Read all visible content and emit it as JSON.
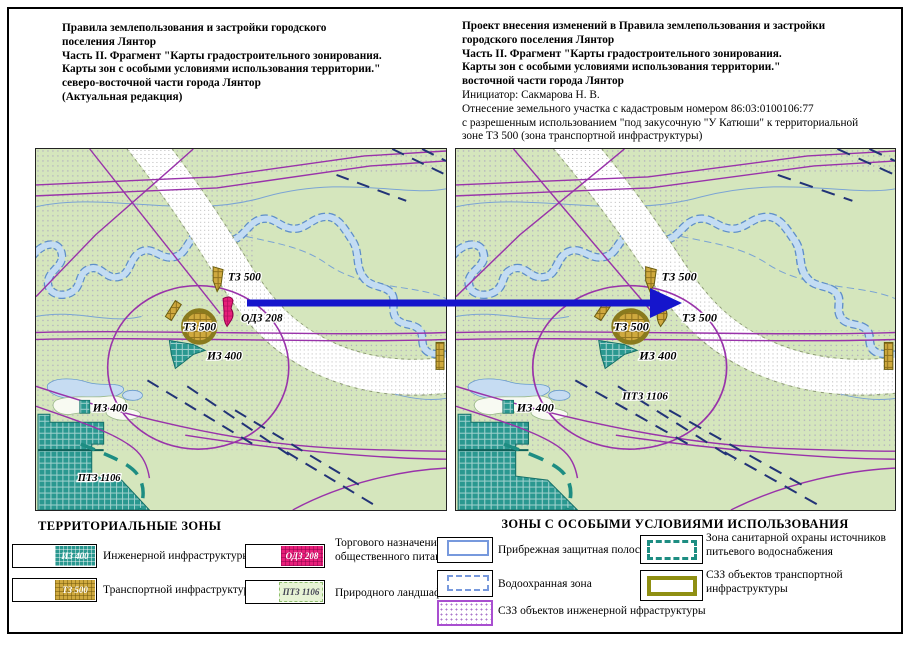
{
  "header_left": {
    "lines": [
      "Правила землепользования и застройки городского",
      "поселения Лянтор",
      "Часть II. Фрагмент \"Карты градостроительного зонирования.",
      "Карты зон с особыми условиями использования территории.\"",
      "северо-восточной части города Лянтор",
      "(Актуальная редакция)"
    ]
  },
  "header_right": {
    "bold_lines": [
      "Проект внесения изменений в Правила землепользования и застройки",
      "городского поселения Лянтор",
      "Часть II. Фрагмент \"Карты градостроительного зонирования.",
      "Карты зон с особыми условиями использования территории.\"",
      "восточной части города Лянтор"
    ],
    "normal_lines": [
      "Инициатор: Сакмарова Н. В.",
      "Отнесение земельного участка с кадастровым номером 86:03:0100106:77",
      "с разрешенным использованием \"под закусочную \"У Катюши\" к территориальной",
      "зоне ТЗ 500 (зона транспортной инфраструктуры)"
    ]
  },
  "maps": {
    "left": {
      "title": "Актуальная редакция",
      "patch_type": "odz",
      "labels": {
        "tz500_top": "ТЗ 500",
        "patch": "ОДЗ 208",
        "tz500_main": "ТЗ 500",
        "iz400_center": "ИЗ 400",
        "iz400_bottom": "ИЗ 400",
        "ptz1106": "ПТЗ 1106"
      }
    },
    "right": {
      "title": "Проект изменений",
      "patch_type": "tz",
      "labels": {
        "tz500_top": "ТЗ 500",
        "patch": "ТЗ 500",
        "tz500_main": "ТЗ 500",
        "iz400_center": "ИЗ 400",
        "iz400_bottom": "ИЗ 400",
        "ptz1106": "ПТЗ 1106"
      }
    }
  },
  "legend_territorial": {
    "title": "ТЕРРИТОРИАЛЬНЫЕ ЗОНЫ",
    "items": [
      {
        "code": "ИЗ 400",
        "color": "#2a9890",
        "label_lines": [
          "Инженерной инфраструктуры"
        ]
      },
      {
        "code": "ТЗ 500",
        "color": "#cfa93e",
        "label_lines": [
          "Транспортной инфраструктуры"
        ]
      },
      {
        "code": "ОДЗ 208",
        "color": "#e81f7a",
        "label_lines": [
          "Торгового назначения и",
          "общественного питания"
        ]
      },
      {
        "code": "ПТЗ 1106",
        "color": "#e7f3d5",
        "label_lines": [
          "Природного ландшафта"
        ]
      }
    ]
  },
  "legend_special": {
    "title": "ЗОНЫ С ОСОБЫМИ УСЛОВИЯМИ ИСПОЛЬЗОВАНИЯ",
    "items": [
      {
        "style": "blue-solid",
        "color": "#7799dd",
        "label_lines": [
          "Прибрежная защитная полоса"
        ]
      },
      {
        "style": "blue-dashed",
        "color": "#7799dd",
        "label_lines": [
          "Водоохранная зона"
        ]
      },
      {
        "style": "purple-dotted",
        "color": "#a94fd0",
        "label_lines": [
          "СЗЗ объектов инженерной нфраструктуры"
        ]
      },
      {
        "style": "teal-dashed",
        "color": "#1d8d82",
        "label_lines": [
          "Зона санитарной охраны источников",
          "питьевого водоснабжения"
        ]
      },
      {
        "style": "olive-solid",
        "color": "#8f8f12",
        "label_lines": [
          "СЗЗ объектов транспортной",
          "инфраструктуры"
        ]
      }
    ]
  },
  "arrow": {
    "color": "#1515cc"
  },
  "colors": {
    "map_background": "#d5e6bd",
    "boundary_purple": "#9933aa",
    "river_blue": "#5f8fc9",
    "navy_dash": "#223377",
    "sanitary_teal": "#1d8d82"
  }
}
